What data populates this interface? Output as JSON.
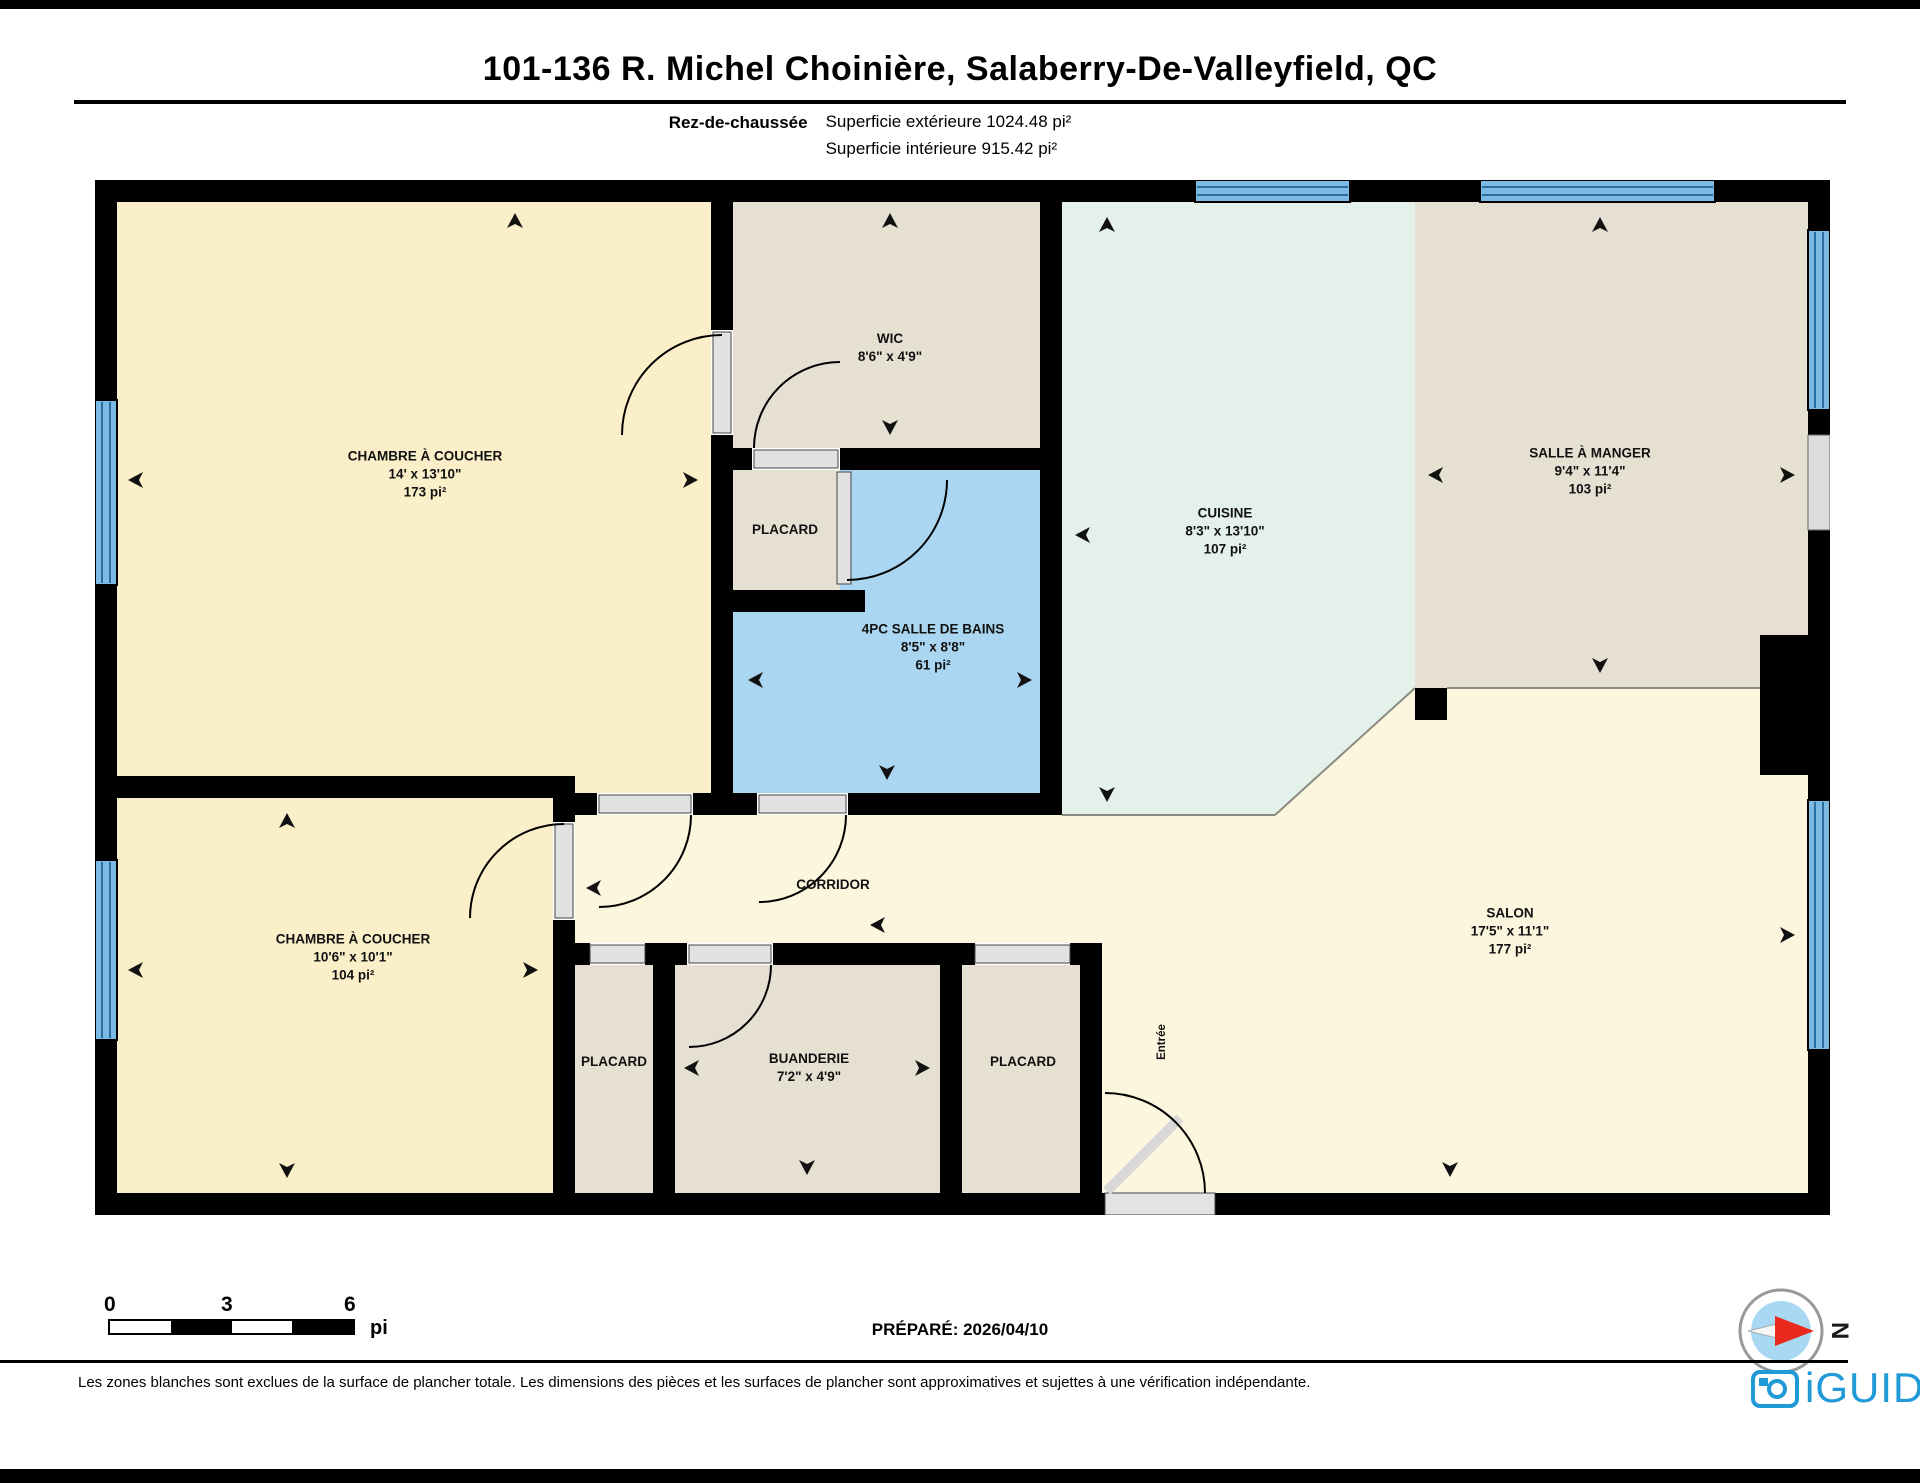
{
  "header": {
    "title": "101-136 R. Michel Choinière, Salaberry-De-Valleyfield, QC",
    "floor_label": "Rez-de-chaussée",
    "exterior_area_label": "Superficie extérieure 1024.48 pi²",
    "interior_area_label": "Superficie intérieure 915.42 pi²"
  },
  "rooms": [
    {
      "name": "CHAMBRE À COUCHER",
      "dims": "14' x 13'10\"",
      "area": "173 pi²"
    },
    {
      "name": "WIC",
      "dims": "8'6\" x 4'9\""
    },
    {
      "name": "PLACARD"
    },
    {
      "name": "4PC SALLE DE BAINS",
      "dims": "8'5\" x 8'8\"",
      "area": "61 pi²"
    },
    {
      "name": "CUISINE",
      "dims": "8'3\" x 13'10\"",
      "area": "107 pi²"
    },
    {
      "name": "SALLE À MANGER",
      "dims": "9'4\" x 11'4\"",
      "area": "103 pi²"
    },
    {
      "name": "CHAMBRE À COUCHER",
      "dims": "10'6\" x 10'1\"",
      "area": "104 pi²"
    },
    {
      "name": "CORRIDOR"
    },
    {
      "name": "PLACARD"
    },
    {
      "name": "BUANDERIE",
      "dims": "7'2\" x 4'9\""
    },
    {
      "name": "PLACARD"
    },
    {
      "name": "SALON",
      "dims": "17'5\" x 11'1\"",
      "area": "177 pi²"
    },
    {
      "name": "Entrée"
    }
  ],
  "scale_bar": {
    "tick_start": "0",
    "tick_mid": "3",
    "tick_end": "6",
    "unit": "pi"
  },
  "prepared_label": "PRÉPARÉ: 2026/04/10",
  "compass": {
    "north_label": "N"
  },
  "footer": {
    "disclaimer": "Les zones blanches sont exclues de la surface de plancher totale. Les dimensions des pièces et les surfaces de plancher sont approximatives et sujettes à une vérification indépendante.",
    "brand": "iGUIDE"
  },
  "colors": {
    "bedroom": "#FBEFC9",
    "taupe": "#E6E0D3",
    "bathroom": "#ABD6F2",
    "kitchen": "#E4F0EA",
    "salon": "#FCF6DE",
    "window": "#7CBAE3",
    "window_line": "#2A6FA0",
    "brand_blue": "#1F9AD6",
    "compass_blue": "#A9D9F2",
    "compass_red": "#E8291C"
  }
}
